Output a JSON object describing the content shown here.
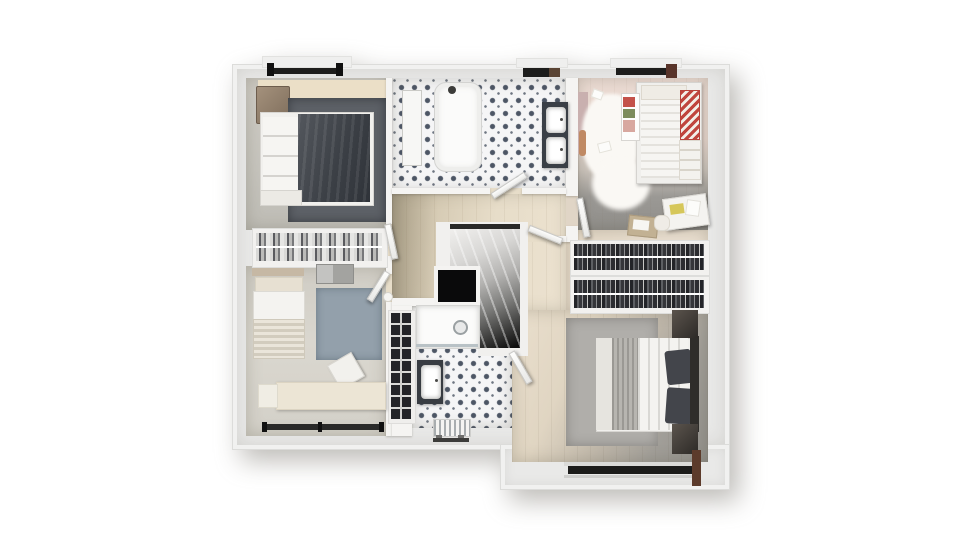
{
  "scene": {
    "description": "3D top-down rendered floor plan of an upper storey",
    "background": "#ffffff",
    "building_shadow": "rgba(110,106,98,0.45)"
  },
  "building": {
    "wall_fill": "#e9e9e8",
    "wall_trim": "#f1f1f0",
    "partition": "#f5f4f2",
    "bump": "#efefee"
  },
  "windows": {
    "glass_dark": "#1d1d1c",
    "frame_black": "#111111",
    "wood_brown": "#5a4434",
    "wood_maroon": "#58342a",
    "sill_outer": "#dadad8",
    "sill_inner": "#cfcfcd",
    "bottom_bar": "#2a2a29",
    "master_bar": "#1c1c1b",
    "shower_room_bar": "#3c3c3a"
  },
  "rooms": {
    "bedroom_top_left": {
      "floor": "#c9c6bf",
      "head_wall_strip": "#ebdfc7",
      "rug": "#5d6167",
      "bed_linen": "#f1f0ed",
      "pillows": "#f6f5f2",
      "bed_duvet": "#3e4248",
      "wardrobe_wood": "#8d7c69",
      "bench": "#eceae5"
    },
    "bedroom_bottom_left": {
      "floor": "#d6d3cb",
      "rug": "#93a0ab",
      "bed_wood": "#c6b8a4",
      "pillow": "#e7e0d2",
      "mattress": "#f4f3f0",
      "blanket": "#ddd6c8",
      "desk": "#ece5d5",
      "side_cabinet": "#f0ede4",
      "chair": "#f2f1ed",
      "dresser": "#a3a3a0"
    },
    "kids_bedroom_top_right": {
      "floor_warm": "#ecdcd4",
      "floor_cool": "#908e8a",
      "fluffy_rug": "#faf8f4",
      "bed_frame": "#f0efec",
      "pillow": "#efece5",
      "stripe_red": "#c0453e",
      "pillow_stack": "#f3f2ee",
      "toy_shelf": "#fdfdfc",
      "toy_red": "#c4524a",
      "toy_green": "#7d8c5c",
      "toy_pink": "#d8a8a0",
      "desk": "#f4f3f0",
      "book_yellow": "#d6c75a",
      "paper": "#fcfcfa",
      "tray": "#c2b193",
      "tray_paper": "#f7f6f2",
      "pouf": "#efece6",
      "accent_orange": "#c08a64",
      "pink_mat": "#c9b0af"
    },
    "family_bathroom": {
      "tile_base": "#f5f5f6",
      "tile_motif": "#4d5665",
      "bathtub": "#fbfbfa",
      "bath_mat": "#f7f7f5",
      "vanity": "#3a3f46",
      "sink": "#ffffff"
    },
    "landing": {
      "floor_light": "#e7ddc9",
      "floor_dark": "#c9bda4",
      "stair_frame": "#f1f0ee",
      "stair_top_bar": "#292928",
      "void_frame": "#f4f3f1",
      "void": "#0a0a0b",
      "bookshelf_frame": "#efeeec",
      "bookshelf_books": "#232428",
      "vase": "#f6f5f2"
    },
    "shower_room": {
      "tile_base": "#f5f5f6",
      "tile_motif": "#4d5665",
      "shower_tray": "#fbfbfa",
      "glass": "#b9c2c6",
      "vanity": "#383c42",
      "sink": "#ffffff",
      "radiator": "#f4f4f2"
    },
    "dressing": {
      "floor": "#eadfd0",
      "rail_frame": "#f2f1ef",
      "clothes_dark": "#2b2d31",
      "clothes_light": "#bfbfbd",
      "rail_line": "#ffffff"
    },
    "master_bedroom": {
      "floor_warm": "#eadfcd",
      "floor_cool": "#92908b",
      "rug": "#b0aeaa",
      "bed_linen": "#f1f0ed",
      "fold": "#e6e4df",
      "throw": "#b7b5b0",
      "duvet": "#f4f3f0",
      "pillow_dark": "#43454b",
      "headboard": "#2f2d2a",
      "nightstand": "#3b3733",
      "wood_post": "#5c3b2b"
    }
  },
  "doors": {
    "leaf": "#fbfbfa"
  },
  "fixtures": {
    "faucet": "#3c3c3a",
    "drain": "#e8e9e9",
    "radiator_legs": "#6e6e6c"
  }
}
